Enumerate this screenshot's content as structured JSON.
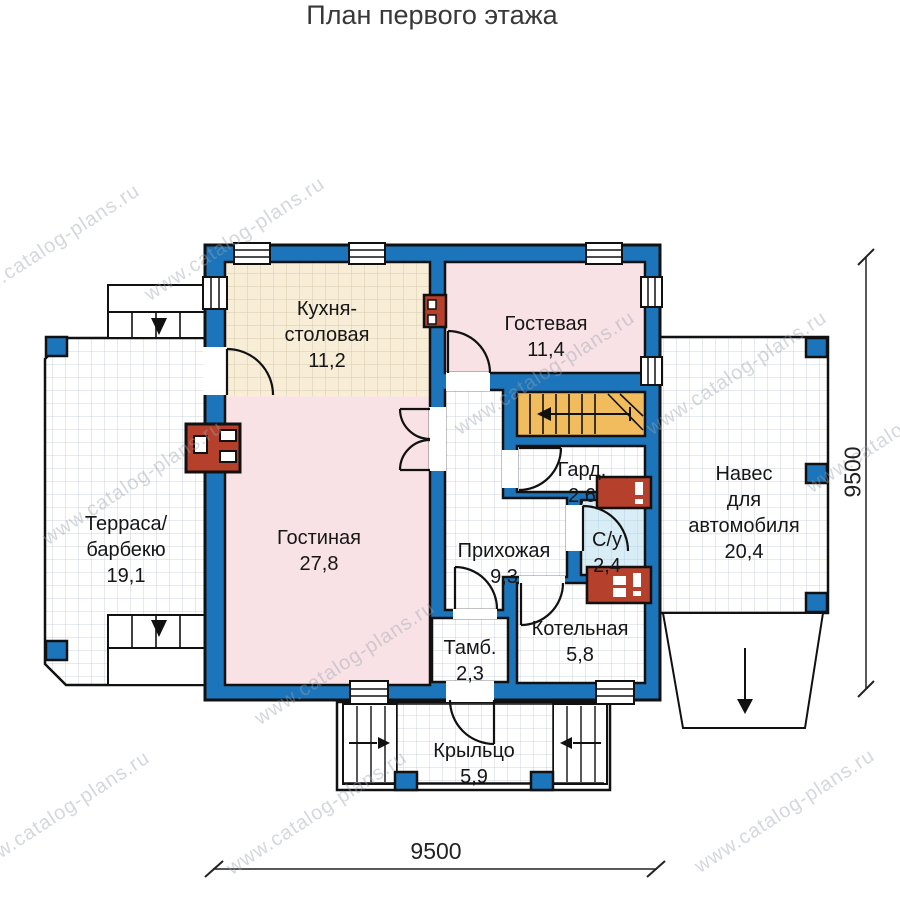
{
  "title": "План первого этажа",
  "watermark": "www.catalog-plans.ru",
  "rooms": {
    "kitchen": {
      "name": "Кухня-\nстоловая",
      "area": "11,2"
    },
    "guest": {
      "name": "Гостевая",
      "area": "11,4"
    },
    "terrace": {
      "name": "Терраса/\nбарбекю",
      "area": "19,1"
    },
    "living": {
      "name": "Гостиная",
      "area": "27,8"
    },
    "hallway": {
      "name": "Прихожая",
      "area": "9,3"
    },
    "wardrobe": {
      "name": "Гард.",
      "area": "2,6"
    },
    "bathroom": {
      "name": "С/у",
      "area": "2,4"
    },
    "vestibule": {
      "name": "Тамб.",
      "area": "2,3"
    },
    "boiler": {
      "name": "Котельная",
      "area": "5,8"
    },
    "carport": {
      "name": "Навес\nдля\nавтомобиля",
      "area": "20,4"
    },
    "porch": {
      "name": "Крыльцо",
      "area": "5,9"
    }
  },
  "dimensions": {
    "bottom": "9500",
    "right": "9500"
  },
  "colors": {
    "wall_blue": "#1c75ba",
    "room_pink": "#f8e2e6",
    "kitchen_tile": "#f8eed8",
    "bath_tile": "#d9edf6",
    "stairs_yellow": "#f1bc5e",
    "equipment_red": "#b5402b"
  },
  "icons": {
    "stairs-direction-arrow": "←",
    "terrace-entry-arrow": "▼",
    "porch-left-steps-arrow": "→",
    "porch-right-steps-arrow": "←",
    "driveway-arrow": "↓"
  }
}
